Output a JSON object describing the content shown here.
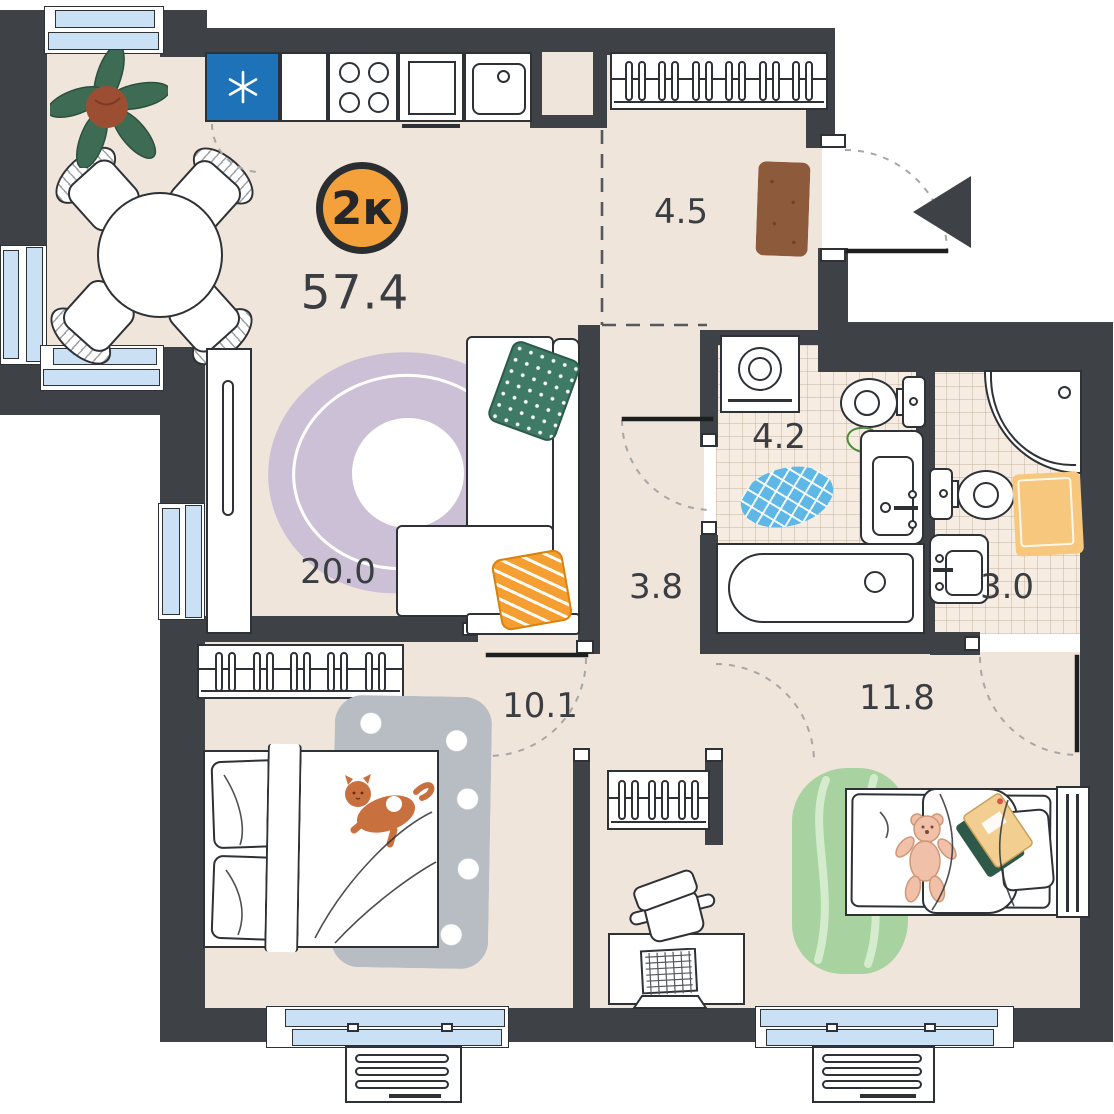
{
  "plan": {
    "badge": "2к",
    "total_area": "57.4",
    "rooms": {
      "hallway": "4.5",
      "bathroom": "4.2",
      "toilet": "3.0",
      "corridor": "3.8",
      "living_kitchen": "20.0",
      "bedroom": "10.1",
      "kids_room": "11.8"
    },
    "colors": {
      "wall": "#3E4246",
      "floor": "#F0E5DA",
      "tile": "#F6ECE2",
      "window": "#C9E0F5",
      "badge_bg": "#F5A13B",
      "fridge": "#1D72B8",
      "pillow_green": "#3E7A66",
      "pillow_orange": "#F59E31",
      "rug_lavender": "#CCC0D6",
      "rug_green": "#A9D2A1",
      "mat_blue": "#5FB7E5",
      "mat_yellow": "#F7C77D",
      "doormat": "#8E5A3C",
      "cat": "#C9703F"
    }
  }
}
